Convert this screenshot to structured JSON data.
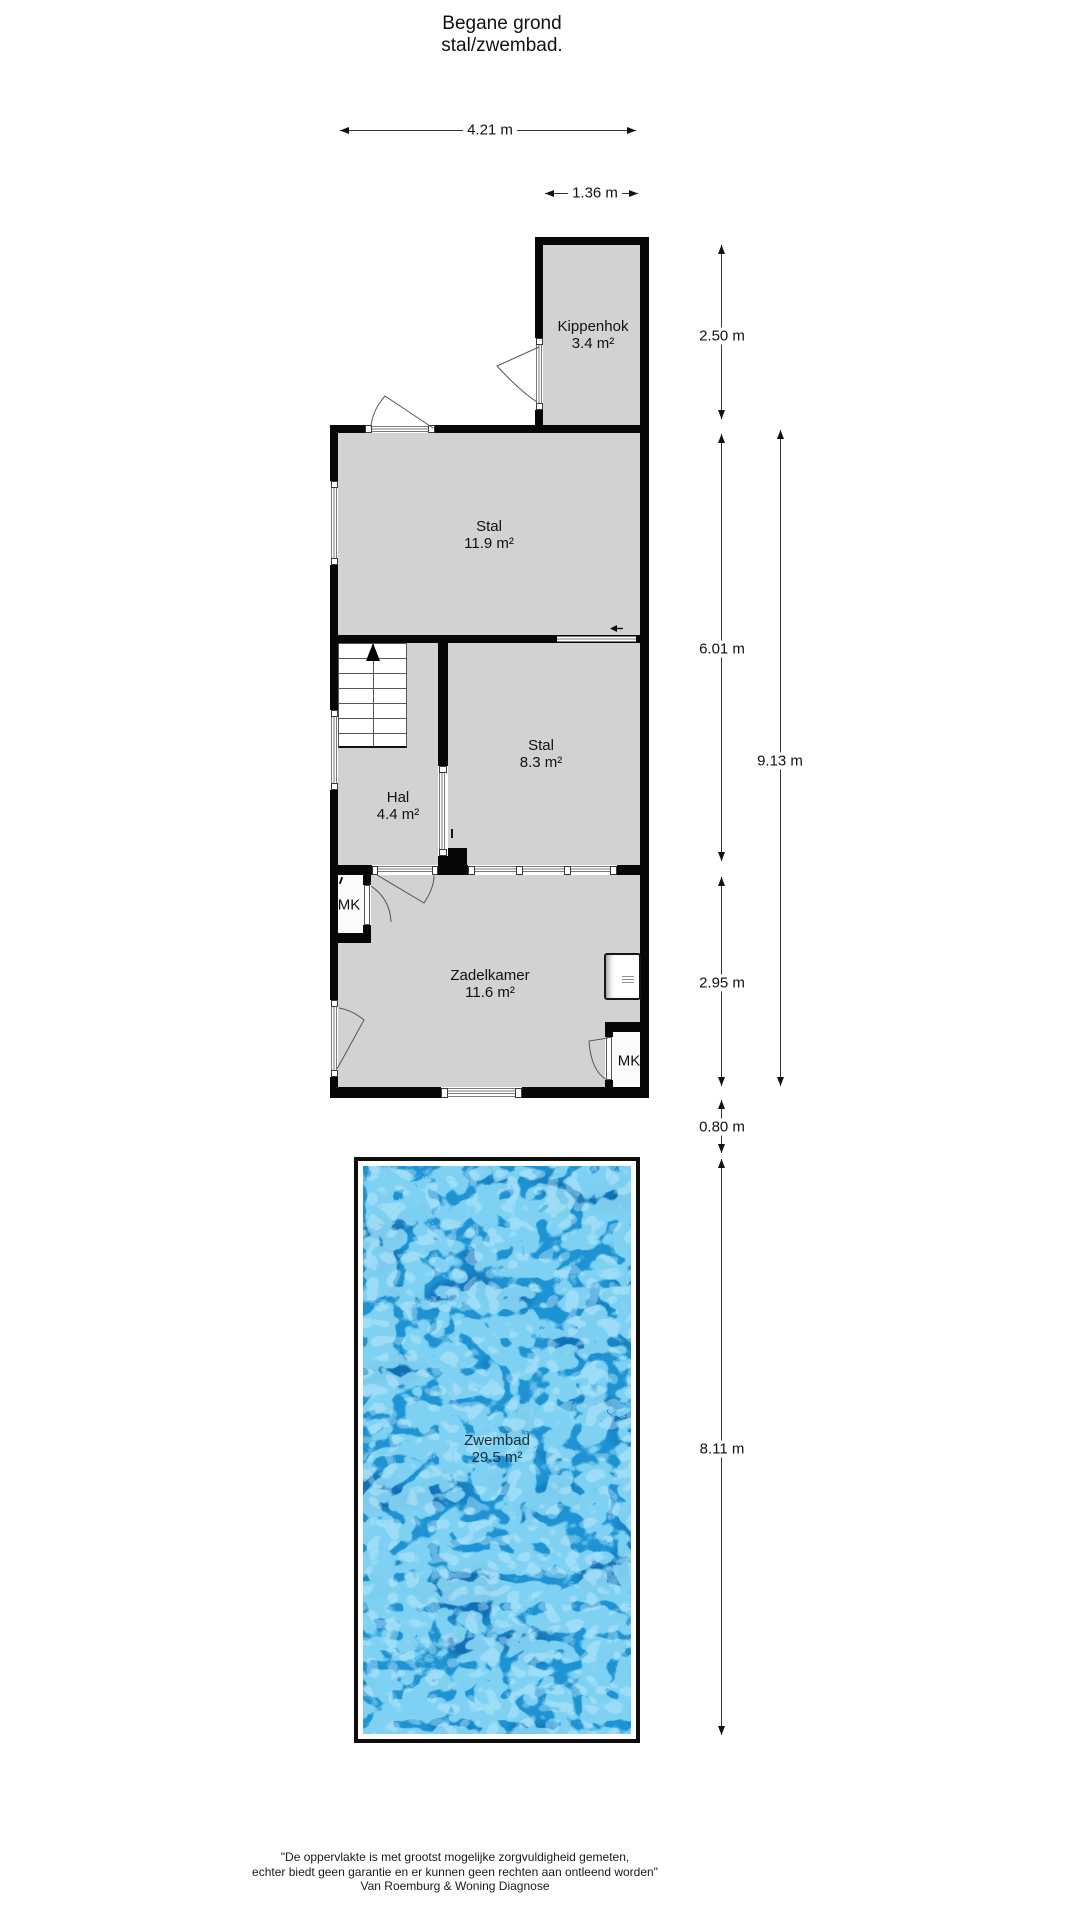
{
  "title": {
    "line1": "Begane grond",
    "line2": "stal/zwembad."
  },
  "rooms": {
    "kippenhok": {
      "name": "Kippenhok",
      "area": "3.4 m²"
    },
    "stal_groot": {
      "name": "Stal",
      "area": "11.9 m²"
    },
    "stal_klein": {
      "name": "Stal",
      "area": "8.3 m²"
    },
    "hal": {
      "name": "Hal",
      "area": "4.4 m²"
    },
    "zadelkamer": {
      "name": "Zadelkamer",
      "area": "11.6 m²"
    },
    "zwembad": {
      "name": "Zwembad",
      "area": "29.5 m²"
    },
    "meterkast_boven": {
      "name": "MK"
    },
    "meterkast_onder": {
      "name": "MK"
    }
  },
  "dimensions": {
    "stal_breedte": "4.21 m",
    "kippenhok_breedte": "1.36 m",
    "kippenhok_hoogte": "2.50 m",
    "stal_hoogte": "6.01 m",
    "gebouw_hoogte": "9.13 m",
    "zadelkamer_hoogte": "2.95 m",
    "tussenruimte": "0.80 m",
    "zwembad_lengte": "8.11 m"
  },
  "footer": {
    "line1": "\"De oppervlakte is met grootst mogelijke zorgvuldigheid gemeten,",
    "line2": "echter biedt geen garantie en er kunnen geen rechten aan ontleend worden\"",
    "line3": "Van Roemburg & Woning Diagnose"
  },
  "colors": {
    "wall": "#070707",
    "room_fill": "#d2d2d2",
    "line": "#333333",
    "water_base": "#1e93d3",
    "water_light": "#8fdcf8",
    "water_dark": "#0d6bb0",
    "water_sparkle": "#cff1ff"
  }
}
